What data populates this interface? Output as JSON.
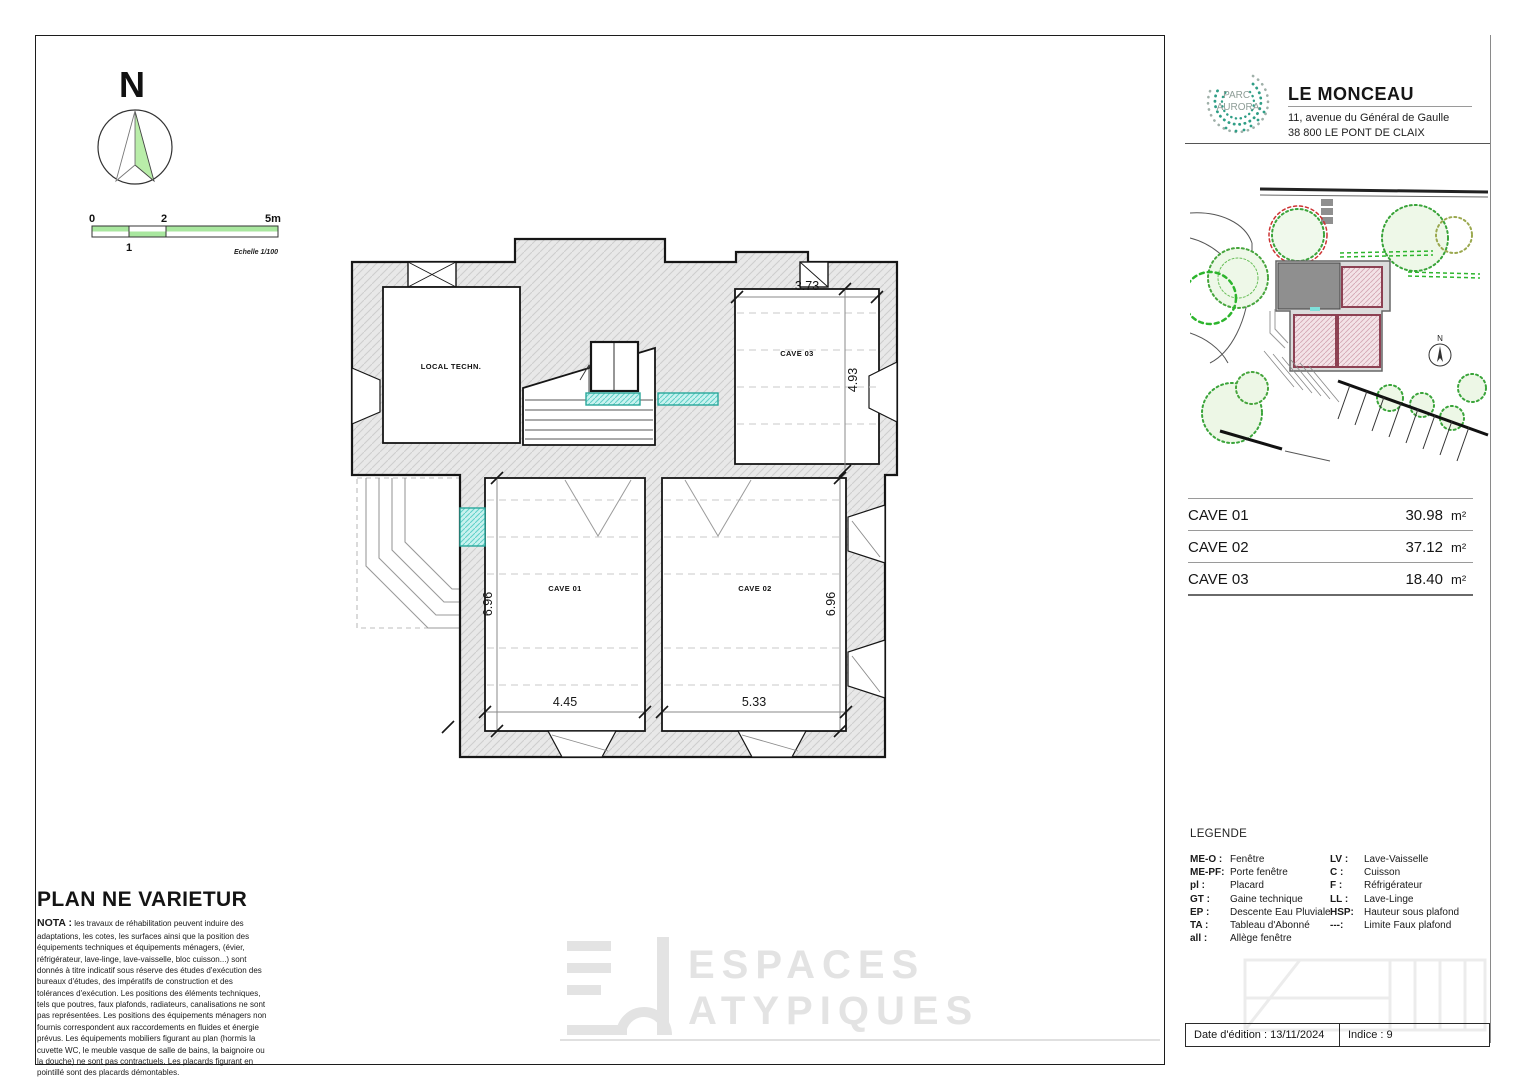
{
  "compass": {
    "label": "N"
  },
  "scale": {
    "zero": "0",
    "two": "2",
    "five": "5m",
    "one": "1",
    "caption": "Echelle 1/100"
  },
  "plan": {
    "rooms": {
      "local_tech": "LOCAL TECHN.",
      "cave01": "CAVE 01",
      "cave02": "CAVE 02",
      "cave03": "CAVE 03"
    },
    "dims": {
      "cave03_w": "3.73",
      "cave03_h": "4.93",
      "cave01_h": "6.96",
      "cave01_w": "4.45",
      "cave02_w": "5.33",
      "cave02_h": "6.96"
    }
  },
  "titleblock": {
    "logo_line1": "PARC",
    "logo_line2": "AURORA",
    "title": "LE MONCEAU",
    "address1": "11, avenue du Général de Gaulle",
    "address2": "38 800 LE PONT DE CLAIX"
  },
  "site_plan": {
    "compass_label": "N"
  },
  "areas": {
    "rows": [
      {
        "label": "CAVE 01",
        "value": "30.98",
        "unit": "m²"
      },
      {
        "label": "CAVE 02",
        "value": "37.12",
        "unit": "m²"
      },
      {
        "label": "CAVE 03",
        "value": "18.40",
        "unit": "m²"
      }
    ]
  },
  "legend": {
    "title": "LEGENDE",
    "left": [
      {
        "abbr": "ME-O :",
        "def": "Fenêtre"
      },
      {
        "abbr": "ME-PF:",
        "def": "Porte fenêtre"
      },
      {
        "abbr": "pl :",
        "def": "Placard"
      },
      {
        "abbr": "GT :",
        "def": "Gaine technique"
      },
      {
        "abbr": "EP :",
        "def": "Descente Eau Pluviale"
      },
      {
        "abbr": "TA :",
        "def": "Tableau d'Abonné"
      },
      {
        "abbr": "all :",
        "def": "Allège fenêtre"
      }
    ],
    "right": [
      {
        "abbr": "LV :",
        "def": "Lave-Vaisselle"
      },
      {
        "abbr": "C :",
        "def": "Cuisson"
      },
      {
        "abbr": "F :",
        "def": "Réfrigérateur"
      },
      {
        "abbr": "LL :",
        "def": "Lave-Linge"
      },
      {
        "abbr": "HSP:",
        "def": "Hauteur sous plafond"
      },
      {
        "abbr": "---:",
        "def": "Limite Faux plafond"
      }
    ]
  },
  "nota": {
    "heading": "PLAN NE VARIETUR",
    "label": "NOTA :",
    "text": "les travaux de réhabilitation peuvent induire des adaptations, les cotes, les surfaces ainsi que la position des équipements techniques et équipements ménagers, (évier, réfrigérateur, lave-linge, lave-vaisselle, bloc cuisson...) sont donnés à titre indicatif sous réserve des études d'exécution des bureaux d'études, des impératifs de construction et des tolérances d'exécution. Les positions des éléments techniques, tels que poutres, faux plafonds, radiateurs, canalisations ne sont pas représentées. Les positions des équipements ménagers non fournis correspondent aux raccordements en fluides et énergie prévus. Les équipements mobiliers figurant au plan (hormis la cuvette WC, le meuble vasque de salle de bains, la baignoire ou la douche) ne sont pas contractuels. Les placards figurant en pointillé sont des placards démontables."
  },
  "watermark": {
    "line1": "ESPACES",
    "line2": "ATYPIQUES"
  },
  "footer": {
    "edition": "Date d'édition : 13/11/2024",
    "indice": "Indice : 9"
  },
  "colors": {
    "scale_green": "#a9e79f",
    "teal": "#2aa79b",
    "cyan_fill": "#c9f2ef",
    "brand_teal": "#2f9e86",
    "tree_green": "#3aa43a",
    "pink_room": "#f3e3e7"
  }
}
